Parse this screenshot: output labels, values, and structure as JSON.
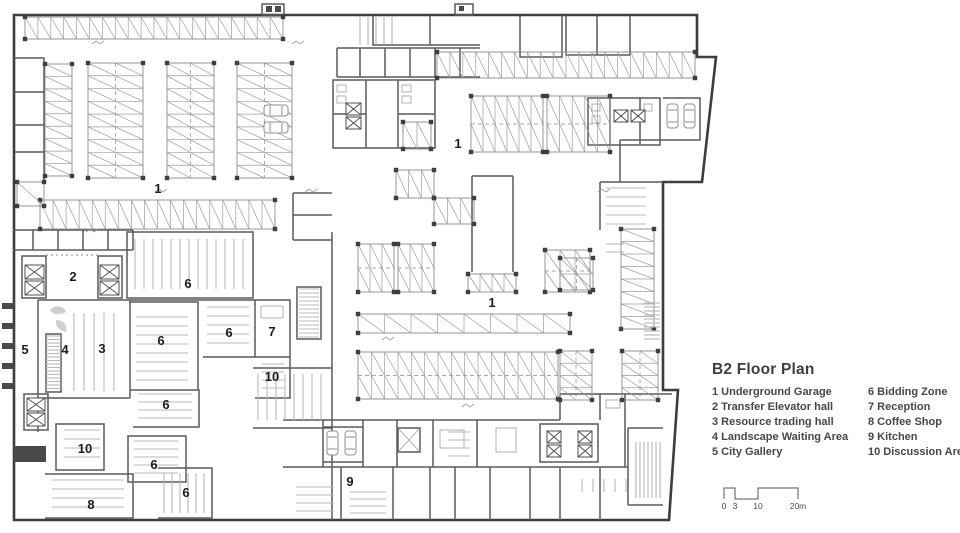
{
  "title": "B2 Floor Plan",
  "legend": {
    "column1": [
      {
        "num": "1",
        "name": "Underground Garage"
      },
      {
        "num": "2",
        "name": "Transfer Elevator hall"
      },
      {
        "num": "3",
        "name": "Resource trading hall"
      },
      {
        "num": "4",
        "name": "Landscape Waiting Area"
      },
      {
        "num": "5",
        "name": "City Gallery"
      }
    ],
    "column2": [
      {
        "num": "6",
        "name": "Bidding Zone"
      },
      {
        "num": "7",
        "name": "Reception"
      },
      {
        "num": "8",
        "name": "Coffee Shop"
      },
      {
        "num": "9",
        "name": "Kitchen"
      },
      {
        "num": "10",
        "name": "Discussion Area"
      }
    ]
  },
  "scale_bar": {
    "ticks": [
      {
        "label": "0",
        "x": 2
      },
      {
        "label": "3",
        "x": 13
      },
      {
        "label": "10",
        "x": 36
      },
      {
        "label": "20m",
        "x": 76
      }
    ]
  },
  "colors": {
    "outline": "#3d3d3d",
    "wall": "#5a5a5a",
    "parking_line": "#9c9c9c",
    "furniture": "#b8b8b8",
    "label_text": "#1c1c1c",
    "panel_text": "#474747"
  },
  "plan_labels": [
    {
      "n": "1",
      "x": 158,
      "y": 189
    },
    {
      "n": "1",
      "x": 458,
      "y": 144
    },
    {
      "n": "1",
      "x": 492,
      "y": 303
    },
    {
      "n": "2",
      "x": 73,
      "y": 277
    },
    {
      "n": "3",
      "x": 102,
      "y": 349
    },
    {
      "n": "4",
      "x": 65,
      "y": 350
    },
    {
      "n": "5",
      "x": 25,
      "y": 350
    },
    {
      "n": "6",
      "x": 188,
      "y": 284
    },
    {
      "n": "6",
      "x": 161,
      "y": 341
    },
    {
      "n": "6",
      "x": 229,
      "y": 333
    },
    {
      "n": "6",
      "x": 166,
      "y": 405
    },
    {
      "n": "6",
      "x": 154,
      "y": 465
    },
    {
      "n": "6",
      "x": 186,
      "y": 493
    },
    {
      "n": "7",
      "x": 272,
      "y": 332
    },
    {
      "n": "8",
      "x": 91,
      "y": 505
    },
    {
      "n": "9",
      "x": 350,
      "y": 482
    },
    {
      "n": "10",
      "x": 272,
      "y": 377
    },
    {
      "n": "10",
      "x": 85,
      "y": 449
    }
  ],
  "parking_blocks": [
    {
      "x": 25,
      "y": 17,
      "w": 258,
      "h": 22,
      "dir": "h",
      "rows": 1
    },
    {
      "x": 437,
      "y": 52,
      "w": 258,
      "h": 26,
      "dir": "h",
      "rows": 1
    },
    {
      "x": 45,
      "y": 64,
      "w": 27,
      "h": 112,
      "dir": "v",
      "rows": 1
    },
    {
      "x": 88,
      "y": 63,
      "w": 55,
      "h": 115,
      "dir": "v",
      "rows": 2
    },
    {
      "x": 167,
      "y": 63,
      "w": 47,
      "h": 115,
      "dir": "v",
      "rows": 2
    },
    {
      "x": 237,
      "y": 63,
      "w": 55,
      "h": 115,
      "dir": "v",
      "rows": 2
    },
    {
      "x": 40,
      "y": 200,
      "w": 235,
      "h": 29,
      "dir": "h",
      "rows": 1
    },
    {
      "x": 403,
      "y": 122,
      "w": 28,
      "h": 27,
      "dir": "h",
      "rows": 1
    },
    {
      "x": 471,
      "y": 96,
      "w": 72,
      "h": 56,
      "dir": "h",
      "rows": 2
    },
    {
      "x": 547,
      "y": 96,
      "w": 63,
      "h": 56,
      "dir": "h",
      "rows": 2
    },
    {
      "x": 396,
      "y": 170,
      "w": 38,
      "h": 28,
      "dir": "h",
      "rows": 1
    },
    {
      "x": 434,
      "y": 198,
      "w": 40,
      "h": 26,
      "dir": "h",
      "rows": 1
    },
    {
      "x": 358,
      "y": 244,
      "w": 36,
      "h": 48,
      "dir": "h",
      "rows": 2
    },
    {
      "x": 398,
      "y": 244,
      "w": 36,
      "h": 48,
      "dir": "h",
      "rows": 2
    },
    {
      "x": 545,
      "y": 250,
      "w": 45,
      "h": 42,
      "dir": "h",
      "rows": 2
    },
    {
      "x": 468,
      "y": 274,
      "w": 48,
      "h": 18,
      "dir": "h",
      "rows": 1
    },
    {
      "x": 358,
      "y": 314,
      "w": 212,
      "h": 19,
      "dir": "h",
      "rows": 1,
      "wide": true
    },
    {
      "x": 358,
      "y": 352,
      "w": 200,
      "h": 47,
      "dir": "h",
      "rows": 2
    },
    {
      "x": 560,
      "y": 351,
      "w": 32,
      "h": 49,
      "dir": "v",
      "rows": 2
    },
    {
      "x": 622,
      "y": 351,
      "w": 36,
      "h": 49,
      "dir": "v",
      "rows": 2
    },
    {
      "x": 621,
      "y": 229,
      "w": 33,
      "h": 100,
      "dir": "v",
      "rows": 1
    },
    {
      "x": 560,
      "y": 258,
      "w": 33,
      "h": 32,
      "dir": "v",
      "rows": 2
    },
    {
      "x": 17,
      "y": 182,
      "w": 27,
      "h": 24,
      "dir": "h",
      "rows": 1,
      "wide": true
    }
  ],
  "elevators": [
    {
      "x": 25,
      "y": 265,
      "w": 19,
      "h": 14
    },
    {
      "x": 25,
      "y": 281,
      "w": 19,
      "h": 14
    },
    {
      "x": 100,
      "y": 265,
      "w": 19,
      "h": 14
    },
    {
      "x": 100,
      "y": 281,
      "w": 19,
      "h": 14
    },
    {
      "x": 27,
      "y": 398,
      "w": 18,
      "h": 13
    },
    {
      "x": 27,
      "y": 413,
      "w": 18,
      "h": 13
    },
    {
      "x": 346,
      "y": 103,
      "w": 15,
      "h": 12
    },
    {
      "x": 346,
      "y": 117,
      "w": 15,
      "h": 12
    },
    {
      "x": 614,
      "y": 110,
      "w": 14,
      "h": 12
    },
    {
      "x": 631,
      "y": 110,
      "w": 14,
      "h": 12
    },
    {
      "x": 547,
      "y": 431,
      "w": 14,
      "h": 12
    },
    {
      "x": 547,
      "y": 445,
      "w": 14,
      "h": 12
    },
    {
      "x": 578,
      "y": 431,
      "w": 14,
      "h": 12
    },
    {
      "x": 578,
      "y": 445,
      "w": 14,
      "h": 12
    }
  ],
  "cars": [
    {
      "x": 264,
      "y": 105,
      "o": "h"
    },
    {
      "x": 264,
      "y": 122,
      "o": "h"
    },
    {
      "x": 667,
      "y": 104,
      "o": "v"
    },
    {
      "x": 684,
      "y": 104,
      "o": "v"
    },
    {
      "x": 327,
      "y": 431,
      "o": "v"
    },
    {
      "x": 345,
      "y": 431,
      "o": "v"
    }
  ],
  "seat_areas": [
    {
      "x": 135,
      "y": 239,
      "w": 108,
      "h": 50,
      "o": "v",
      "gap": 9
    },
    {
      "x": 136,
      "y": 317,
      "w": 52,
      "h": 66,
      "o": "h",
      "gap": 9
    },
    {
      "x": 207,
      "y": 307,
      "w": 42,
      "h": 38,
      "o": "h",
      "gap": 9
    },
    {
      "x": 138,
      "y": 394,
      "w": 54,
      "h": 28,
      "o": "h",
      "gap": 8
    },
    {
      "x": 134,
      "y": 441,
      "w": 44,
      "h": 34,
      "o": "h",
      "gap": 8
    },
    {
      "x": 164,
      "y": 473,
      "w": 42,
      "h": 40,
      "o": "v",
      "gap": 8
    },
    {
      "x": 74,
      "y": 313,
      "w": 44,
      "h": 78,
      "o": "v",
      "gap": 10
    },
    {
      "x": 64,
      "y": 430,
      "w": 36,
      "h": 34,
      "o": "h",
      "gap": 9
    },
    {
      "x": 52,
      "y": 480,
      "w": 72,
      "h": 32,
      "o": "h",
      "gap": 9
    },
    {
      "x": 262,
      "y": 364,
      "w": 22,
      "h": 24,
      "o": "h",
      "gap": 8
    },
    {
      "x": 258,
      "y": 374,
      "w": 68,
      "h": 46,
      "o": "v",
      "gap": 9
    },
    {
      "x": 582,
      "y": 479,
      "w": 44,
      "h": 13,
      "o": "v",
      "gap": 11
    },
    {
      "x": 636,
      "y": 442,
      "w": 25,
      "h": 56,
      "o": "v",
      "gap": 4
    },
    {
      "x": 46,
      "y": 336,
      "w": 15,
      "h": 54,
      "o": "h",
      "gap": 3.5
    },
    {
      "x": 299,
      "y": 289,
      "w": 20,
      "h": 48,
      "o": "h",
      "gap": 4
    },
    {
      "x": 644,
      "y": 303,
      "w": 16,
      "h": 36,
      "o": "h",
      "gap": 4
    },
    {
      "x": 606,
      "y": 188,
      "w": 40,
      "h": 36,
      "o": "h",
      "gap": 9
    },
    {
      "x": 448,
      "y": 432,
      "w": 22,
      "h": 26,
      "o": "h",
      "gap": 8
    },
    {
      "x": 296,
      "y": 487,
      "w": 38,
      "h": 30,
      "o": "h",
      "gap": 8
    },
    {
      "x": 350,
      "y": 492,
      "w": 36,
      "h": 22,
      "o": "h",
      "gap": 7
    }
  ]
}
